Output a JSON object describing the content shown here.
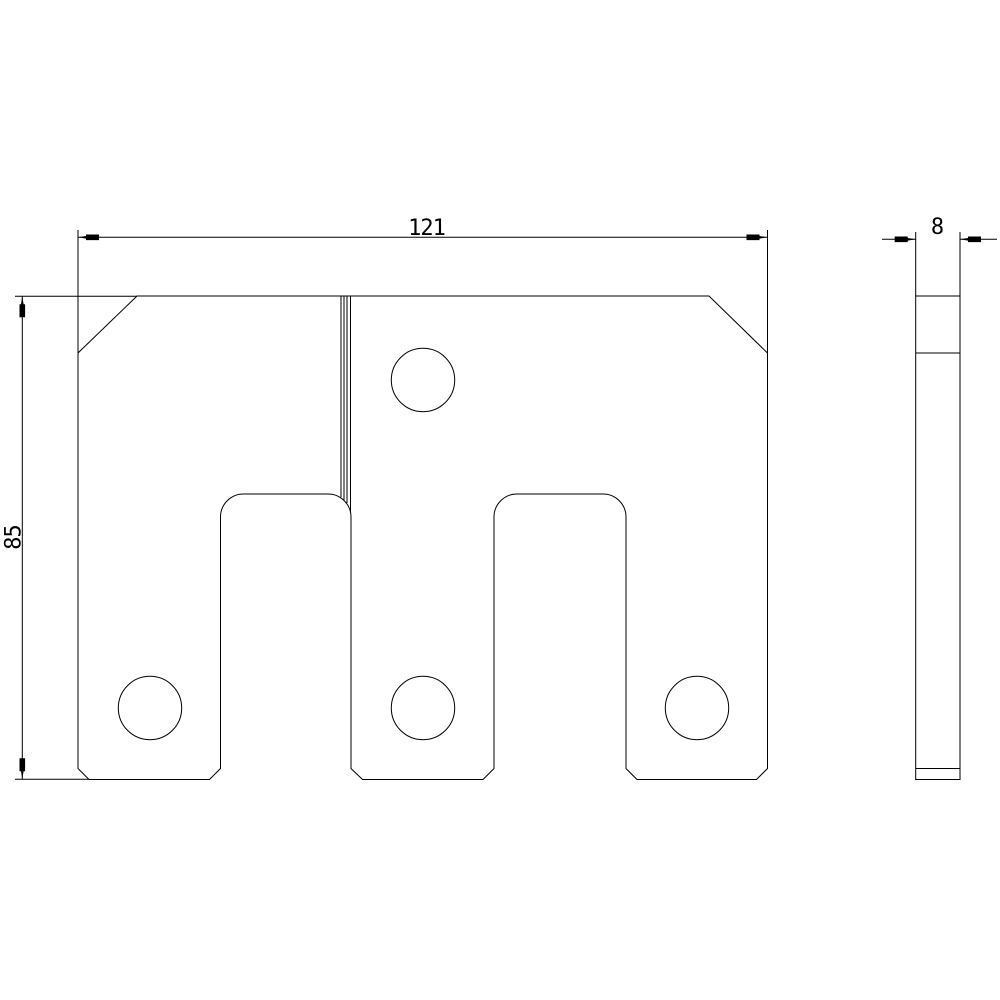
{
  "drawing": {
    "background_color": "#ffffff",
    "line_color": "#000000",
    "views": {
      "front": {
        "holes_count": 4,
        "notches_count": 2
      },
      "side": {}
    },
    "dimensions": {
      "width": {
        "label": "121"
      },
      "height": {
        "label": "85"
      },
      "thickness": {
        "label": "8"
      }
    }
  }
}
